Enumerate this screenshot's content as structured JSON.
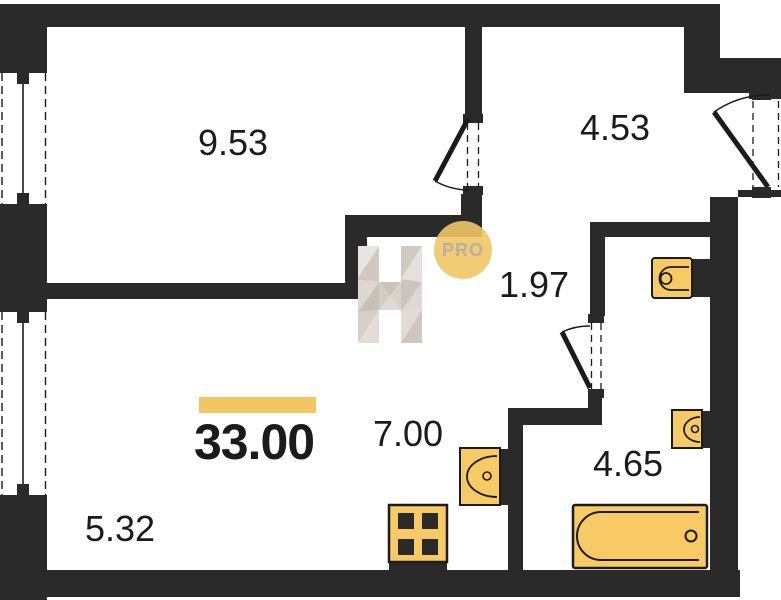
{
  "plan": {
    "title": "apartment-floor-plan",
    "total_area": "33.00",
    "rooms": [
      {
        "id": "living-room",
        "area": "9.53"
      },
      {
        "id": "entry-hall",
        "area": "4.53"
      },
      {
        "id": "corridor",
        "area": "1.97"
      },
      {
        "id": "kitchen-niche",
        "area": "7.00"
      },
      {
        "id": "bathroom",
        "area": "4.65"
      },
      {
        "id": "lower-room",
        "area": "5.32"
      }
    ],
    "logo": {
      "letter": "H",
      "badge": "PRO"
    },
    "fixtures": [
      "toilet",
      "wash-basin",
      "kitchen-sink",
      "stove",
      "bathtub"
    ],
    "colors": {
      "wall": "#2A2A2A",
      "fixture": "#F7CA66",
      "accent": "#F2C660",
      "text": "#1B1B1B",
      "badge-bg": "#F0C765",
      "badge-text": "#B3A896"
    }
  }
}
